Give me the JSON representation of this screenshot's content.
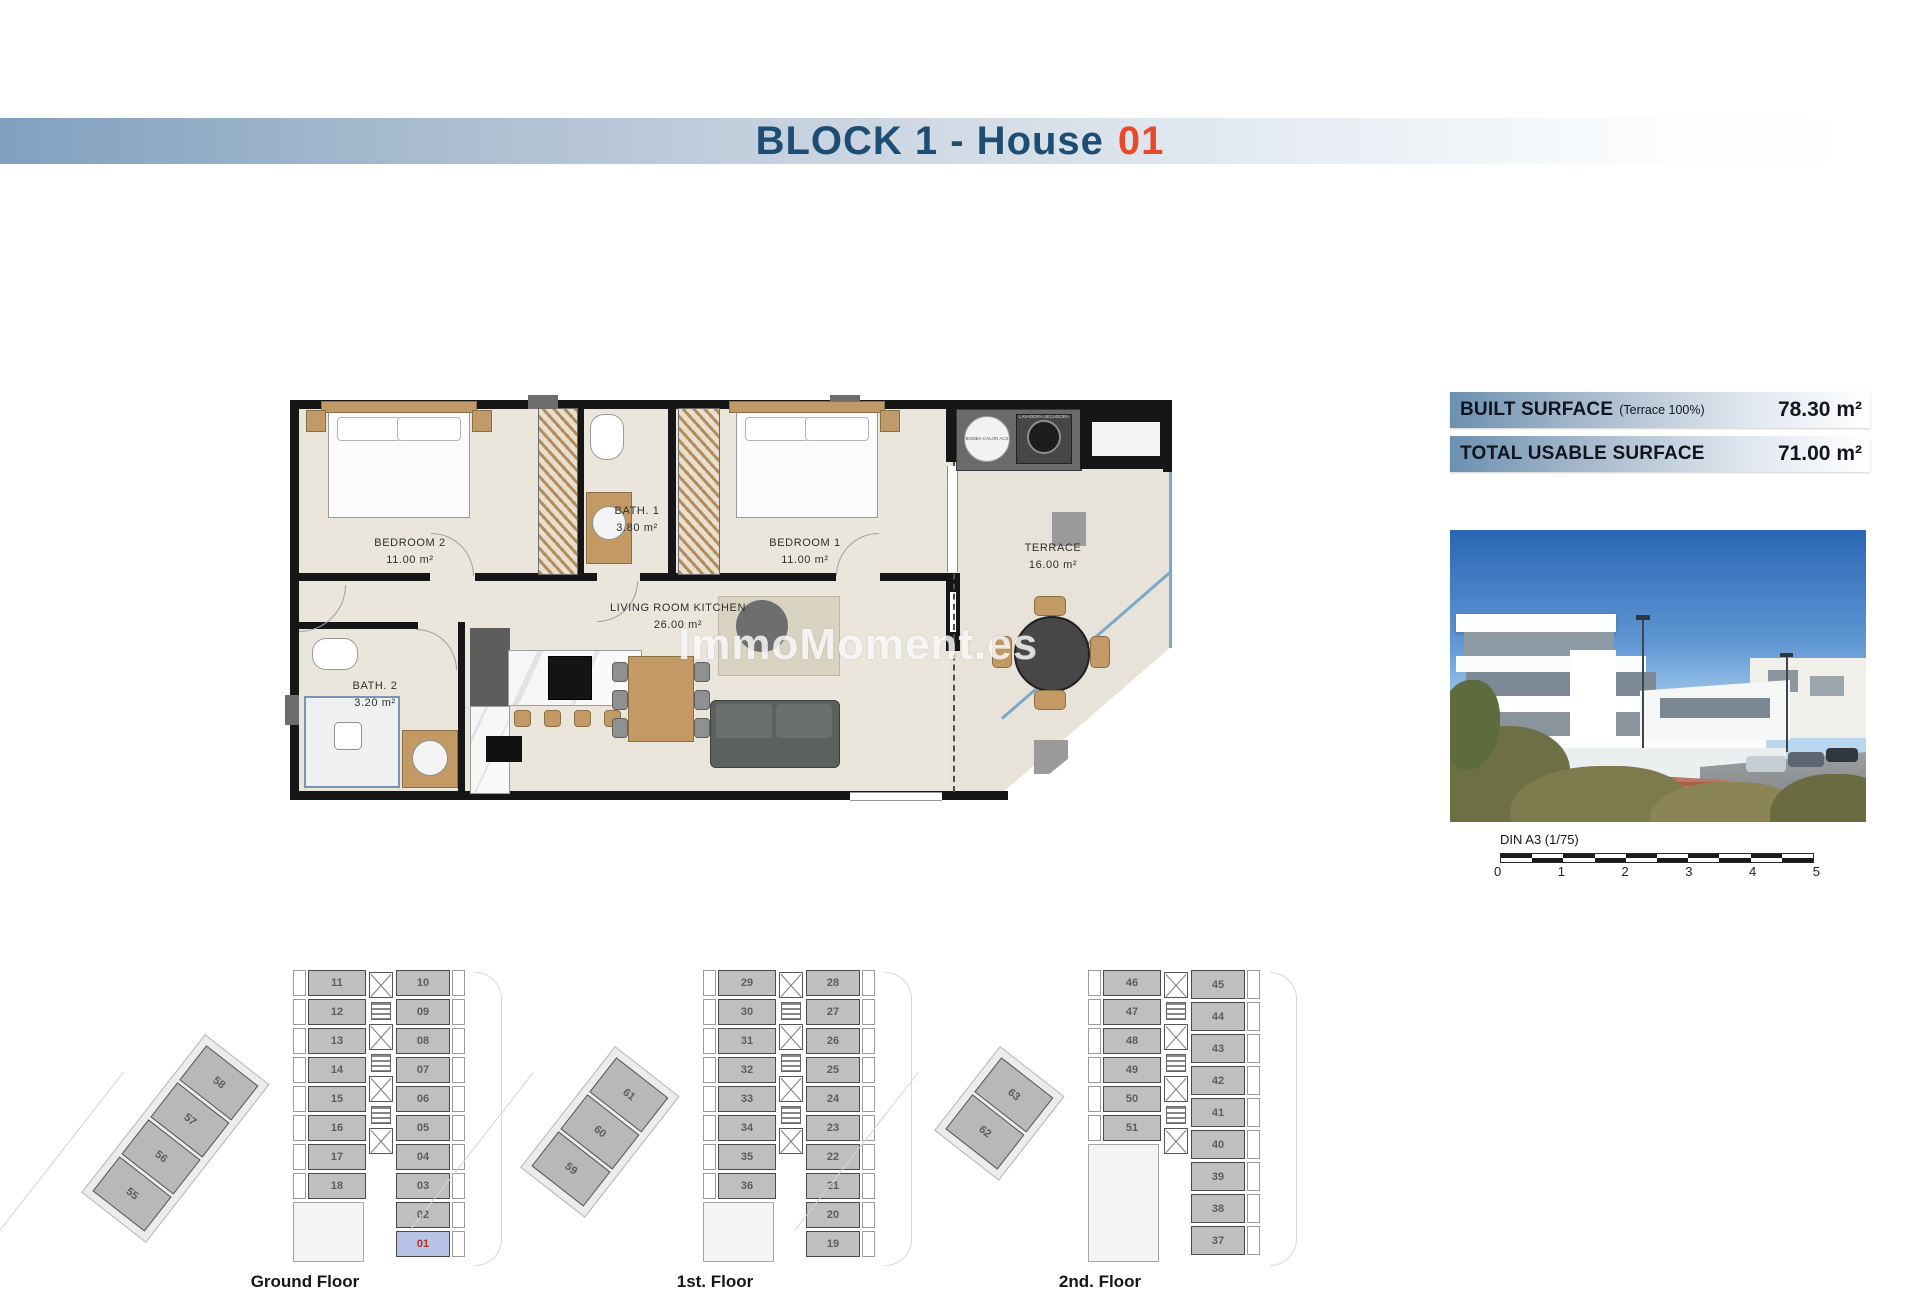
{
  "header": {
    "title": "BLOCK 1 - House",
    "number": "01"
  },
  "colors": {
    "title_blue": "#1d4d72",
    "title_orange": "#e8492a",
    "band_blue": "#7fa1c0",
    "highlight_unit_bg": "#b7c3e6",
    "highlight_unit_text": "#b03026"
  },
  "surface_info": [
    {
      "label": "BUILT SURFACE",
      "note": "(Terrace 100%)",
      "value": "78.30 m²"
    },
    {
      "label": "TOTAL USABLE SURFACE",
      "note": "",
      "value": "71.00 m²"
    }
  ],
  "plan": {
    "watermark": "ImmoMoment.es",
    "rooms": [
      {
        "name": "BEDROOM 2",
        "area": "11.00 m²"
      },
      {
        "name": "BATH. 1",
        "area": "3.80 m²"
      },
      {
        "name": "BEDROOM 1",
        "area": "11.00 m²"
      },
      {
        "name": "LIVING ROOM KITCHEN",
        "area": "26.00 m²"
      },
      {
        "name": "BATH. 2",
        "area": "3.20 m²"
      },
      {
        "name": "TERRACE",
        "area": "16.00 m²"
      }
    ],
    "utility": {
      "unit1": "BOMBA CALOR ACS",
      "unit2": "LAVADORA SECADORA"
    }
  },
  "scale_bar": {
    "label": "DIN A3 (1/75)",
    "ticks": [
      "0",
      "1",
      "2",
      "3",
      "4",
      "5"
    ]
  },
  "floors": [
    {
      "label": "Ground Floor",
      "left_column": [
        "11",
        "12",
        "13",
        "14",
        "15",
        "16",
        "17",
        "18"
      ],
      "right_column": [
        "10",
        "09",
        "08",
        "07",
        "06",
        "05",
        "04",
        "03",
        "02",
        "01"
      ],
      "wing": [
        "58",
        "57",
        "56",
        "55"
      ],
      "highlight": "01"
    },
    {
      "label": "1st. Floor",
      "left_column": [
        "29",
        "30",
        "31",
        "32",
        "33",
        "34",
        "35",
        "36"
      ],
      "right_column": [
        "28",
        "27",
        "26",
        "25",
        "24",
        "23",
        "22",
        "21",
        "20",
        "19"
      ],
      "wing": [
        "61",
        "60",
        "59"
      ],
      "highlight": ""
    },
    {
      "label": "2nd. Floor",
      "left_column": [
        "46",
        "47",
        "48",
        "49",
        "50",
        "51"
      ],
      "right_column": [
        "45",
        "44",
        "43",
        "42",
        "41",
        "40",
        "39",
        "38",
        "37"
      ],
      "wing": [
        "63",
        "62"
      ],
      "highlight": ""
    }
  ]
}
